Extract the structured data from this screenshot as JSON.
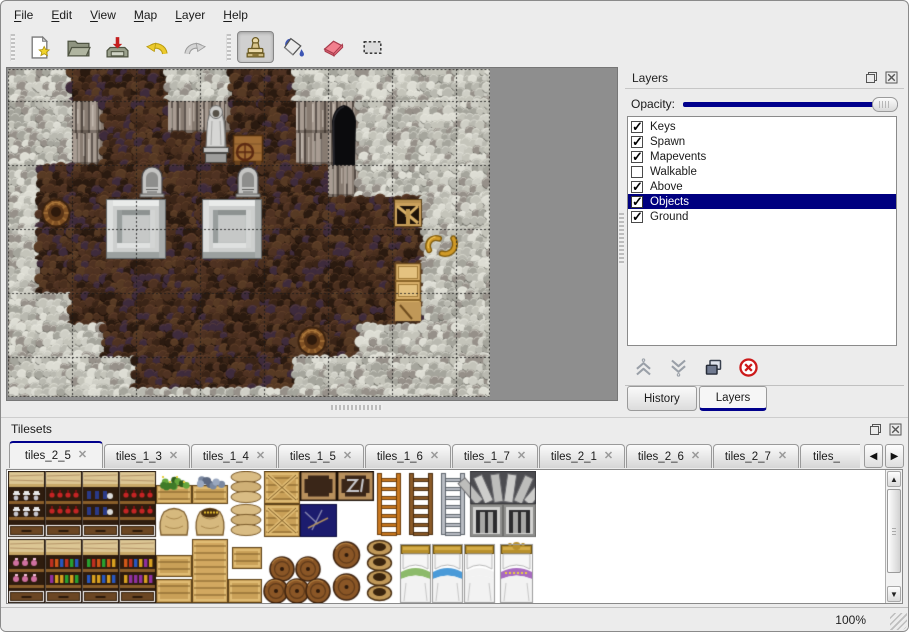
{
  "menu_bar": {
    "items": [
      "File",
      "Edit",
      "View",
      "Map",
      "Layer",
      "Help"
    ]
  },
  "toolbar": {
    "groups": [
      {
        "buttons": [
          {
            "icon": "new-file-icon",
            "selected": false
          },
          {
            "icon": "open-folder-icon",
            "selected": false
          },
          {
            "icon": "save-icon",
            "selected": false
          },
          {
            "icon": "undo-icon",
            "selected": false
          },
          {
            "icon": "redo-icon",
            "selected": false
          }
        ]
      },
      {
        "buttons": [
          {
            "icon": "stamp-tool-icon",
            "selected": true
          },
          {
            "icon": "fill-tool-icon",
            "selected": false
          },
          {
            "icon": "eraser-tool-icon",
            "selected": false
          },
          {
            "icon": "select-tool-icon",
            "selected": false
          }
        ]
      }
    ]
  },
  "map_view": {
    "tile_size": 32,
    "grid_line_every": 64,
    "legend": {
      "W": "wall-top",
      "V": "wall-face",
      "F": "floor",
      "C": "cave-entrance"
    },
    "ground_grid": [
      "WWFFFWWFFWWWWWWW",
      "WWVFFVVFFVCWWWWW",
      "WWVFFFFFFVCWWWWW",
      "WFFFFFFFFFVWWWWW",
      "WFFFFFFFFFFFFWWW",
      "WFFFFFFFFFFFFWWW",
      "WFFFFFFFFFFFFWWW",
      "WWFFFFFFFFFFFWWW",
      "WWWFFFFFFFFWWWWW",
      "WWWWFFFFFWWWWWWW",
      "WWWWWWWWWWWWWWWW"
    ],
    "objects": [
      {
        "type": "statue",
        "col": 6,
        "row": 1
      },
      {
        "type": "table-wheel",
        "col": 7,
        "row": 2
      },
      {
        "type": "gravestone",
        "col": 4,
        "row": 3
      },
      {
        "type": "gravestone",
        "col": 7,
        "row": 3
      },
      {
        "type": "tomb",
        "col": 3,
        "row": 4
      },
      {
        "type": "tomb",
        "col": 6,
        "row": 4
      },
      {
        "type": "barrel",
        "col": 1,
        "row": 4
      },
      {
        "type": "barrel",
        "col": 9,
        "row": 8
      },
      {
        "type": "broken-crate",
        "col": 12,
        "row": 4
      },
      {
        "type": "horns",
        "col": 13,
        "row": 5
      },
      {
        "type": "cabinet",
        "col": 12,
        "row": 6
      }
    ]
  },
  "layers_panel": {
    "title": "Layers",
    "opacity_label": "Opacity:",
    "opacity_percent": 100,
    "layers": [
      {
        "name": "Keys",
        "checked": true,
        "selected": false
      },
      {
        "name": "Spawn",
        "checked": true,
        "selected": false
      },
      {
        "name": "Mapevents",
        "checked": true,
        "selected": false
      },
      {
        "name": "Walkable",
        "checked": false,
        "selected": false
      },
      {
        "name": "Above",
        "checked": true,
        "selected": false
      },
      {
        "name": "Objects",
        "checked": true,
        "selected": true
      },
      {
        "name": "Ground",
        "checked": true,
        "selected": false
      }
    ],
    "action_buttons": [
      {
        "icon": "move-layer-up-icon"
      },
      {
        "icon": "move-layer-down-icon"
      },
      {
        "icon": "duplicate-layer-icon"
      },
      {
        "icon": "delete-layer-icon"
      }
    ],
    "dock_tabs": [
      {
        "label": "History",
        "active": false
      },
      {
        "label": "Layers",
        "active": true
      }
    ],
    "titlebar_buttons": [
      {
        "icon": "float-panel-icon"
      },
      {
        "icon": "close-panel-icon"
      }
    ]
  },
  "tilesets_panel": {
    "title": "Tilesets",
    "titlebar_buttons": [
      {
        "icon": "float-panel-icon"
      },
      {
        "icon": "close-panel-icon"
      }
    ],
    "tabs": [
      {
        "label": "tiles_2_5",
        "active": true,
        "partial": false
      },
      {
        "label": "tiles_1_3",
        "active": false,
        "partial": false
      },
      {
        "label": "tiles_1_4",
        "active": false,
        "partial": false
      },
      {
        "label": "tiles_1_5",
        "active": false,
        "partial": false
      },
      {
        "label": "tiles_1_6",
        "active": false,
        "partial": false
      },
      {
        "label": "tiles_1_7",
        "active": false,
        "partial": false
      },
      {
        "label": "tiles_2_1",
        "active": false,
        "partial": false
      },
      {
        "label": "tiles_2_6",
        "active": false,
        "partial": false
      },
      {
        "label": "tiles_2_7",
        "active": false,
        "partial": false
      },
      {
        "label": "tiles_",
        "active": false,
        "partial": true
      }
    ],
    "scroll_buttons": [
      {
        "icon": "tab-scroll-left-icon",
        "glyph": "◀"
      },
      {
        "icon": "tab-scroll-right-icon",
        "glyph": "▶"
      }
    ],
    "sprites": [
      {
        "type": "cabinet",
        "x": 0,
        "y": 0,
        "w": 37,
        "h": 66,
        "variant": "dishes"
      },
      {
        "type": "cabinet",
        "x": 37,
        "y": 0,
        "w": 37,
        "h": 66,
        "variant": "red-bottles"
      },
      {
        "type": "cabinet",
        "x": 74,
        "y": 0,
        "w": 37,
        "h": 66,
        "variant": "blue-bottles"
      },
      {
        "type": "cabinet",
        "x": 111,
        "y": 0,
        "w": 37,
        "h": 66,
        "variant": "red-bottles"
      },
      {
        "type": "plant-box",
        "x": 148,
        "y": 0,
        "w": 36,
        "h": 33
      },
      {
        "type": "rock-box",
        "x": 184,
        "y": 0,
        "w": 36,
        "h": 33
      },
      {
        "type": "sack-top",
        "x": 220,
        "y": 0,
        "w": 36,
        "h": 33
      },
      {
        "type": "crate-x",
        "x": 256,
        "y": 0,
        "w": 36,
        "h": 33
      },
      {
        "type": "sack",
        "x": 148,
        "y": 33,
        "w": 36,
        "h": 33
      },
      {
        "type": "open-sack",
        "x": 184,
        "y": 33,
        "w": 36,
        "h": 33
      },
      {
        "type": "sack-pile",
        "x": 220,
        "y": 33,
        "w": 36,
        "h": 33
      },
      {
        "type": "crate-x",
        "x": 256,
        "y": 33,
        "w": 36,
        "h": 33
      },
      {
        "type": "dark-crate",
        "x": 292,
        "y": 0,
        "w": 37,
        "h": 30,
        "variant": "plain"
      },
      {
        "type": "dark-crate",
        "x": 329,
        "y": 0,
        "w": 37,
        "h": 30,
        "variant": "graffiti"
      },
      {
        "type": "navy-tile",
        "x": 292,
        "y": 33,
        "w": 37,
        "h": 33
      },
      {
        "type": "ladder",
        "x": 366,
        "y": 0,
        "w": 30,
        "h": 66,
        "variant": "orange"
      },
      {
        "type": "ladder",
        "x": 398,
        "y": 0,
        "w": 30,
        "h": 66,
        "variant": "brown"
      },
      {
        "type": "ladder",
        "x": 430,
        "y": 0,
        "w": 30,
        "h": 66,
        "variant": "steel"
      },
      {
        "type": "arch-stones",
        "x": 462,
        "y": 0,
        "w": 66,
        "h": 33
      },
      {
        "type": "stone-window",
        "x": 462,
        "y": 33,
        "w": 33,
        "h": 33
      },
      {
        "type": "stone-window",
        "x": 495,
        "y": 33,
        "w": 33,
        "h": 33
      },
      {
        "type": "cabinet",
        "x": 0,
        "y": 68,
        "w": 37,
        "h": 64,
        "variant": "pink-jars"
      },
      {
        "type": "cabinet",
        "x": 37,
        "y": 68,
        "w": 37,
        "h": 64,
        "variant": "multi-bottles"
      },
      {
        "type": "cabinet",
        "x": 74,
        "y": 68,
        "w": 37,
        "h": 64,
        "variant": "multi-bottles"
      },
      {
        "type": "cabinet",
        "x": 111,
        "y": 68,
        "w": 37,
        "h": 64,
        "variant": "multi-bottles"
      },
      {
        "type": "crate",
        "x": 148,
        "y": 84,
        "w": 36,
        "h": 22
      },
      {
        "type": "crate-tall",
        "x": 184,
        "y": 68,
        "w": 36,
        "h": 64
      },
      {
        "type": "crate",
        "x": 224,
        "y": 76,
        "w": 30,
        "h": 22
      },
      {
        "type": "crate",
        "x": 148,
        "y": 108,
        "w": 36,
        "h": 24
      },
      {
        "type": "crate",
        "x": 220,
        "y": 108,
        "w": 34,
        "h": 24
      },
      {
        "type": "barrel-pile",
        "x": 256,
        "y": 84,
        "w": 66,
        "h": 48
      },
      {
        "type": "barrel-side",
        "x": 322,
        "y": 68,
        "w": 33,
        "h": 32
      },
      {
        "type": "barrel-side",
        "x": 322,
        "y": 100,
        "w": 33,
        "h": 32
      },
      {
        "type": "pot-stack",
        "x": 355,
        "y": 68,
        "w": 33,
        "h": 64
      },
      {
        "type": "bed",
        "x": 392,
        "y": 72,
        "w": 31,
        "h": 60,
        "variant": "green"
      },
      {
        "type": "bed",
        "x": 424,
        "y": 72,
        "w": 31,
        "h": 60,
        "variant": "blue"
      },
      {
        "type": "bed",
        "x": 456,
        "y": 72,
        "w": 31,
        "h": 60,
        "variant": "white"
      },
      {
        "type": "bed",
        "x": 492,
        "y": 72,
        "w": 33,
        "h": 60,
        "variant": "purple"
      }
    ]
  },
  "status_bar": {
    "zoom_level": "100%"
  },
  "colors": {
    "accent": "#00008c",
    "selection": "#000080",
    "panel_bg": "#ececec",
    "map_empty_bg": "#8e8e8e",
    "list_bg": "#ffffff"
  }
}
